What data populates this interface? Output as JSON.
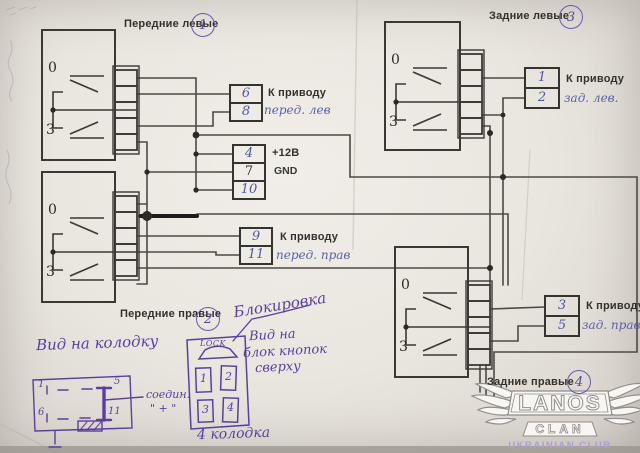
{
  "switches": [
    {
      "name": "Передние левые",
      "circle": "1",
      "pos_top": "0",
      "pos_bottom": "3"
    },
    {
      "name": "Передние правые",
      "circle": "2",
      "pos_top": "0",
      "pos_bottom": "3"
    },
    {
      "name": "Задние левые",
      "circle": "3",
      "pos_top": "0",
      "pos_bottom": "3"
    },
    {
      "name": "Задние правые",
      "circle": "4",
      "pos_top": "0",
      "pos_bottom": "3"
    }
  ],
  "connectors": [
    {
      "pins": [
        "6",
        "8"
      ],
      "label": "К приводу",
      "note": "перед. лев"
    },
    {
      "pins": [
        "4",
        "7",
        "10"
      ],
      "label_top": "+12В",
      "label_mid": "GND"
    },
    {
      "pins": [
        "9",
        "11"
      ],
      "label": "К приводу",
      "note": "перед. прав"
    },
    {
      "pins": [
        "1",
        "2"
      ],
      "label": "К приводу",
      "note": "зад. лев."
    },
    {
      "pins": [
        "3",
        "5"
      ],
      "label": "К приводу",
      "note": "зад. прав"
    }
  ],
  "button_block": {
    "lock": "LOCK",
    "buttons": [
      "1",
      "2",
      "3",
      "4"
    ],
    "caption": "4 колодка",
    "note_lock": "Блокировка",
    "view_lines": [
      "Вид на",
      "блок кнопок",
      "сверху"
    ]
  },
  "connector_view": {
    "title": "Вид на колодку",
    "pins": [
      "1",
      "5",
      "6",
      "11"
    ],
    "join_line1": "соедин.",
    "join_line2": "\" + \""
  },
  "watermark": {
    "name": "LANOS",
    "sub": "CLAN",
    "tagline": "UKRAINIAN CLUB"
  },
  "colors": {
    "paper": "#e9e5df",
    "print_black": "#33312e",
    "ink_blue": "#4d58a4",
    "ink_violet": "#5a3f9f",
    "logo_lavender": "#ab9fd6"
  }
}
